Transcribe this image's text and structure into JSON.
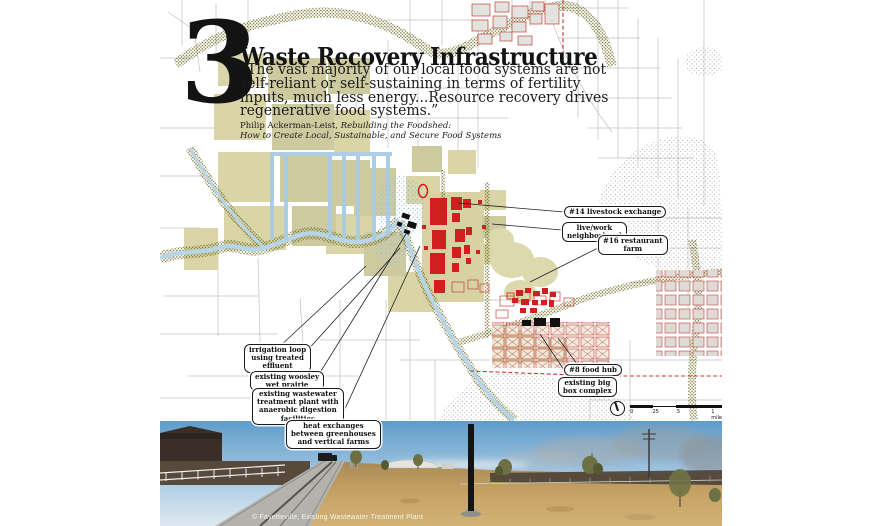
{
  "poster": {
    "section_number": "3",
    "title": "Waste Recovery Infrastructure",
    "quote": "“The vast majority of our local food systems are not\nself-reliant or self-sustaining in terms of fertility\ninputs, much less energy...Resource recovery drives\nregenerative food systems.”",
    "attribution_author": "Philip Ackerman-Leist, ",
    "attribution_work": "Rebuilding the Foodshed:\nHow to Create Local, Sustainable, and Secure Food Systems"
  },
  "map": {
    "callouts": [
      {
        "id": "livestock-exchange",
        "text": "#14 livestock exchange"
      },
      {
        "id": "live-work-neighborhood",
        "text": "live/work\nneighborhood"
      },
      {
        "id": "restaurant-farm",
        "text": "#16 restaurant\nfarm"
      },
      {
        "id": "irrigation-loop",
        "text": "irrigation loop\nusing treated\neffluent"
      },
      {
        "id": "woosley-wet-prairie",
        "text": "existing woosley\nwet prairie"
      },
      {
        "id": "wastewater-plant",
        "text": "existing wastewater\ntreatment plant with\nanaerobic digestion\nfacilities"
      },
      {
        "id": "heat-exchanges",
        "text": "heat exchanges\nbetween greenhouses\nand vertical farms"
      },
      {
        "id": "food-hub",
        "text": "#8 food hub"
      },
      {
        "id": "big-box-complex",
        "text": "existing big\nbox complex"
      }
    ],
    "scalebar": {
      "ticks": [
        "0",
        ".25",
        ".5"
      ],
      "end_label": "1 mile"
    }
  },
  "photo": {
    "caption": "© Fayetteville, Existing Wastewater Treatment Plant"
  },
  "colors": {
    "field_khaki": "#d9d5a6",
    "vegetation_olive": "#6e6a25",
    "river_blue": "#b7d5e7",
    "irrigation_blue": "#a9cbe3",
    "building_red": "#d01f1f",
    "city_outline_red": "#c2413a",
    "dashed_red": "#c0392b",
    "building_black": "#111111"
  }
}
